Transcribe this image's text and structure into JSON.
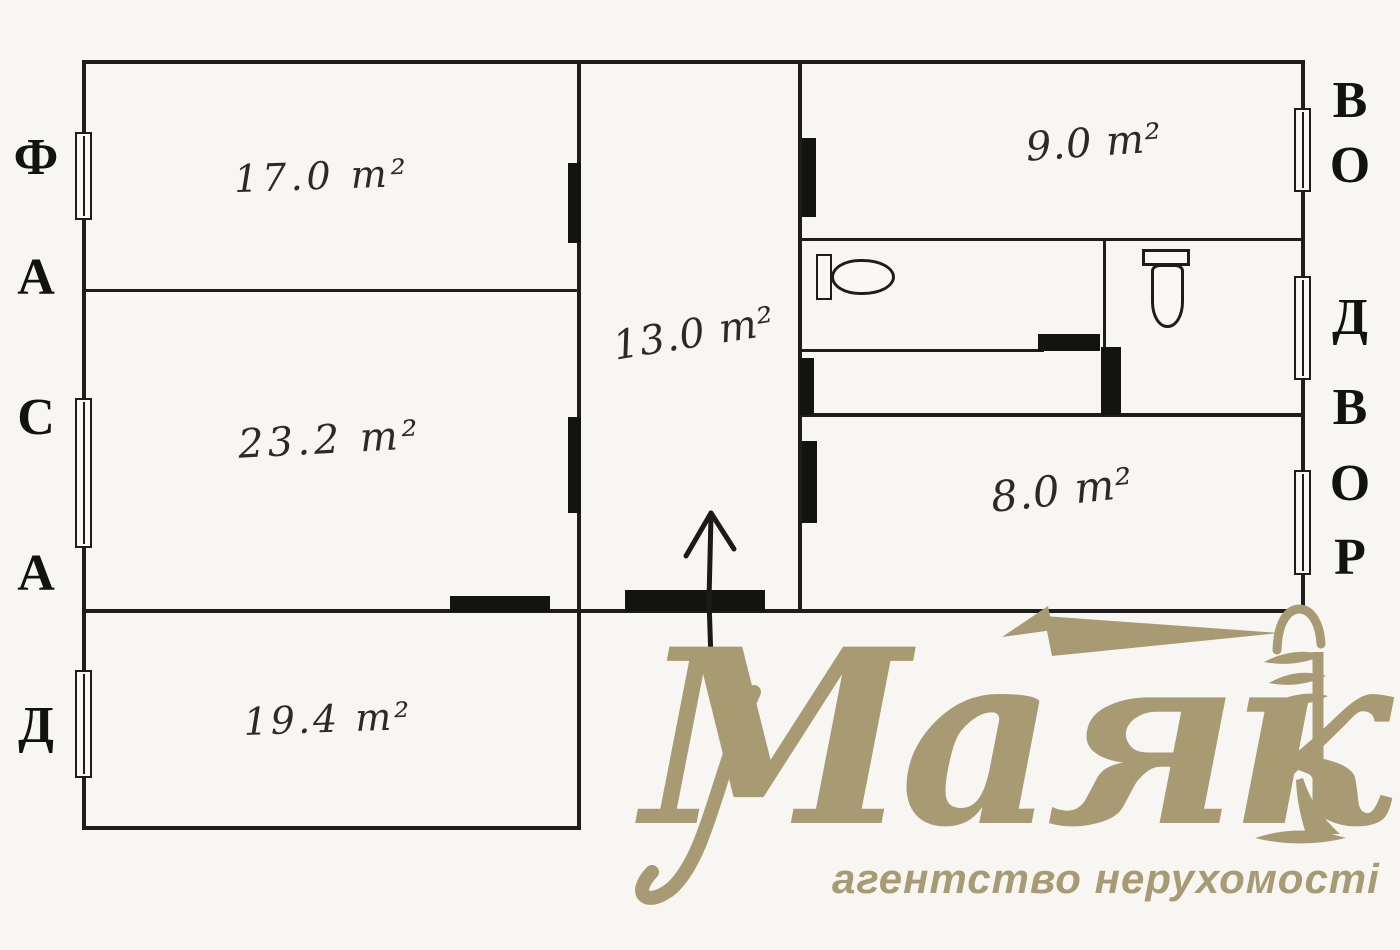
{
  "document": {
    "type": "scanned floor plan with real-estate agency watermark"
  },
  "plan": {
    "rooms": [
      {
        "name": "room-top-left",
        "label": "17.0 m²"
      },
      {
        "name": "room-middle-left",
        "label": "23.2 m²"
      },
      {
        "name": "room-bottom-left",
        "label": "19.4 m²"
      },
      {
        "name": "hallway-center",
        "label": "13.0 m²"
      },
      {
        "name": "room-top-right",
        "label": "9.0 m²"
      },
      {
        "name": "room-bottom-right",
        "label": "8.0 m²"
      }
    ],
    "facade_side": {
      "word": "ФАСАД",
      "letters": [
        "Ф",
        "А",
        "С",
        "А",
        "Д"
      ]
    },
    "yard_side": {
      "word": "ВО ДВОР",
      "letters": [
        "В",
        "О",
        "Д",
        "В",
        "О",
        "Р"
      ]
    },
    "icons": [
      "entrance-arrow",
      "sink-fixture",
      "toilet-fixture",
      "window-symbol",
      "door-jamb",
      "door-sill"
    ]
  },
  "logo": {
    "brand": "Маяк",
    "tagline": "агентство нерухомості",
    "icon": "lighthouse-with-beams",
    "color": "#a89b74"
  },
  "palette": {
    "ink": "#1e1d1b",
    "paper": "#f7f6f3",
    "gold": "#a89b74"
  }
}
